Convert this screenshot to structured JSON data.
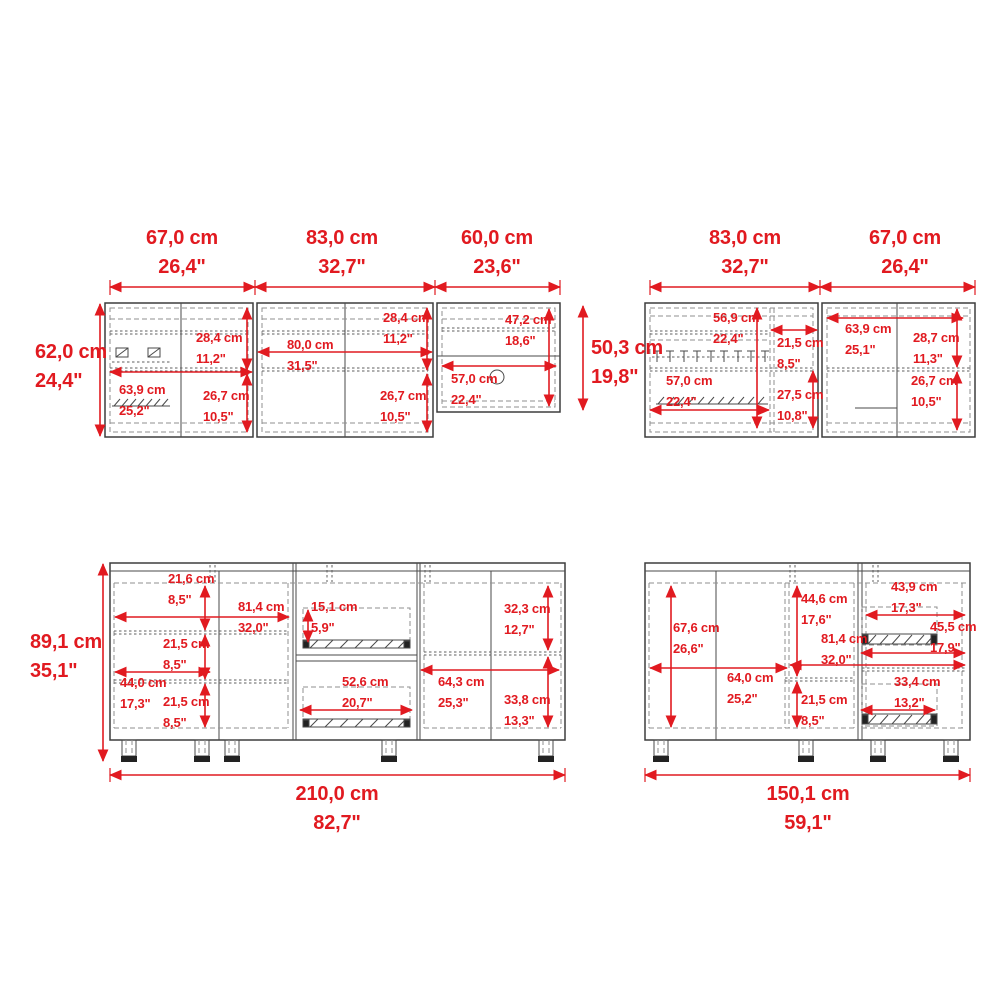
{
  "meta": {
    "type": "furniture-dimension-diagram",
    "units": [
      "cm",
      "inches"
    ]
  },
  "colors": {
    "dimension_red": "#e11a20",
    "outline_dark": "#3d3d3d",
    "dashed_gray": "#8f8f8f",
    "background": "#ffffff"
  },
  "views": {
    "upper_long": {
      "top_widths": [
        {
          "cm": "67,0 cm",
          "in": "26,4\""
        },
        {
          "cm": "83,0 cm",
          "in": "32,7\""
        },
        {
          "cm": "60,0 cm",
          "in": "23,6\""
        }
      ],
      "left_height": {
        "cm": "62,0 cm",
        "in": "24,4\""
      },
      "right_section_height": {
        "cm": "50,3 cm",
        "in": "19,8\""
      },
      "inner_dims": [
        {
          "cm": "28,4 cm",
          "in": "11,2\""
        },
        {
          "cm": "63,9 cm",
          "in": "25,2\""
        },
        {
          "cm": "26,7 cm",
          "in": "10,5\""
        },
        {
          "cm": "80,0 cm",
          "in": "31,5\""
        },
        {
          "cm": "28,4 cm",
          "in": "11,2\""
        },
        {
          "cm": "26,7 cm",
          "in": "10,5\""
        },
        {
          "cm": "47,2 cm",
          "in": "18,6\""
        },
        {
          "cm": "57,0 cm",
          "in": "22,4\""
        }
      ]
    },
    "upper_short": {
      "top_widths": [
        {
          "cm": "83,0 cm",
          "in": "32,7\""
        },
        {
          "cm": "67,0 cm",
          "in": "26,4\""
        }
      ],
      "inner_dims": [
        {
          "cm": "56,9 cm",
          "in": "22,4\""
        },
        {
          "cm": "21,5 cm",
          "in": "8,5\""
        },
        {
          "cm": "57,0 cm",
          "in": "22,4\""
        },
        {
          "cm": "27,5 cm",
          "in": "10,8\""
        },
        {
          "cm": "63,9 cm",
          "in": "25,1\""
        },
        {
          "cm": "28,7 cm",
          "in": "11,3\""
        },
        {
          "cm": "26,7 cm",
          "in": "10,5\""
        }
      ]
    },
    "base_long": {
      "left_height": {
        "cm": "89,1 cm",
        "in": "35,1\""
      },
      "total_width": {
        "cm": "210,0 cm",
        "in": "82,7\""
      },
      "inner_dims": [
        {
          "cm": "21,6 cm",
          "in": "8,5\""
        },
        {
          "cm": "81,4 cm",
          "in": "32,0\""
        },
        {
          "cm": "21,5 cm",
          "in": "8,5\""
        },
        {
          "cm": "44,0 cm",
          "in": "17,3\""
        },
        {
          "cm": "21,5 cm",
          "in": "8,5\""
        },
        {
          "cm": "15,1 cm",
          "in": "5,9\""
        },
        {
          "cm": "52,6 cm",
          "in": "20,7\""
        },
        {
          "cm": "64,3 cm",
          "in": "25,3\""
        },
        {
          "cm": "32,3 cm",
          "in": "12,7\""
        },
        {
          "cm": "33,8 cm",
          "in": "13,3\""
        }
      ]
    },
    "base_short": {
      "total_width": {
        "cm": "150,1 cm",
        "in": "59,1\""
      },
      "inner_dims": [
        {
          "cm": "67,6 cm",
          "in": "26,6\""
        },
        {
          "cm": "64,0 cm",
          "in": "25,2\""
        },
        {
          "cm": "44,6 cm",
          "in": "17,6\""
        },
        {
          "cm": "81,4 cm",
          "in": "32,0\""
        },
        {
          "cm": "21,5 cm",
          "in": "8,5\""
        },
        {
          "cm": "43,9 cm",
          "in": "17,3\""
        },
        {
          "cm": "45,5 cm",
          "in": "17,9\""
        },
        {
          "cm": "33,4 cm",
          "in": "13,2\""
        }
      ]
    }
  }
}
